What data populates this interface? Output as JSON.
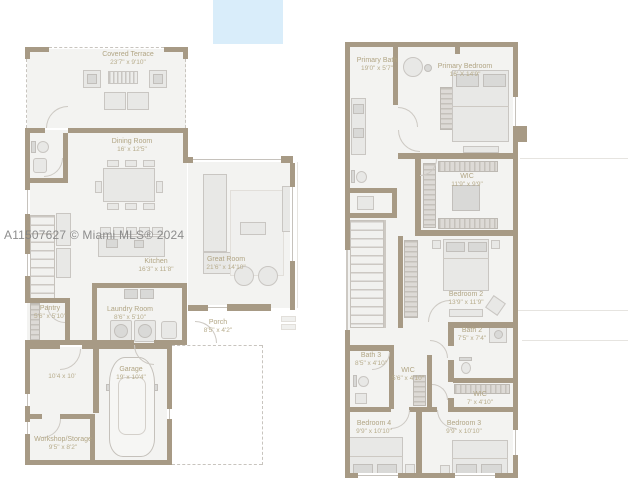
{
  "watermark": "A11507627 © Miami MLS® 2024",
  "colors": {
    "wall": "#a79a85",
    "room_fill": "#f3f3f1",
    "label_text": "#b1a584",
    "accent_blue_rect": "#d9edfa"
  },
  "floor1": {
    "covered_terrace": {
      "name": "Covered Terrace",
      "dims": "23'7\" x 9'10\""
    },
    "dining_room": {
      "name": "Dining Room",
      "dims": "16' x 12'5\""
    },
    "kitchen": {
      "name": "Kitchen",
      "dims": "16'3\" x 11'8\""
    },
    "great_room": {
      "name": "Great Room",
      "dims": "21'6\" x 14'10\""
    },
    "pantry": {
      "name": "Pantry",
      "dims": "5'6\" x 5'10\""
    },
    "laundry_room": {
      "name": "Laundry Room",
      "dims": "8'6\" x 5'10\""
    },
    "porch": {
      "name": "Porch",
      "dims": "8'5\" x 4'2\""
    },
    "flex_room": {
      "dims": "10'4 x 10'"
    },
    "garage": {
      "name": "Garage",
      "dims": "19' x 10'4\""
    },
    "workshop": {
      "name": "Workshop/Storage",
      "dims": "9'5\" x 8'2\""
    }
  },
  "floor2": {
    "primary_bath": {
      "name": "Primary Bath",
      "dims": "19'0\" x 5'7\""
    },
    "primary_bedroom": {
      "name": "Primary Bedroom",
      "dims": "16' X 14'9\""
    },
    "primary_wic": {
      "name": "WIC",
      "dims": "11'9\" x 9'9\""
    },
    "bedroom_2": {
      "name": "Bedroom 2",
      "dims": "13'9\" x 11'9\""
    },
    "bath_2": {
      "name": "Bath 2",
      "dims": "7'5\" x 7'4\""
    },
    "bath_3": {
      "name": "Bath 3",
      "dims": "8'5\" x 4'10\""
    },
    "wic_small": {
      "name": "WIC",
      "dims": "5'6\" x 4'10\""
    },
    "wic_bedroom3": {
      "name": "WIC",
      "dims": "7' x 4'10\""
    },
    "bedroom_4": {
      "name": "Bedroom 4",
      "dims": "9'9\" x 10'10\""
    },
    "bedroom_3": {
      "name": "Bedroom 3",
      "dims": "9'9\" x 10'10\""
    }
  }
}
